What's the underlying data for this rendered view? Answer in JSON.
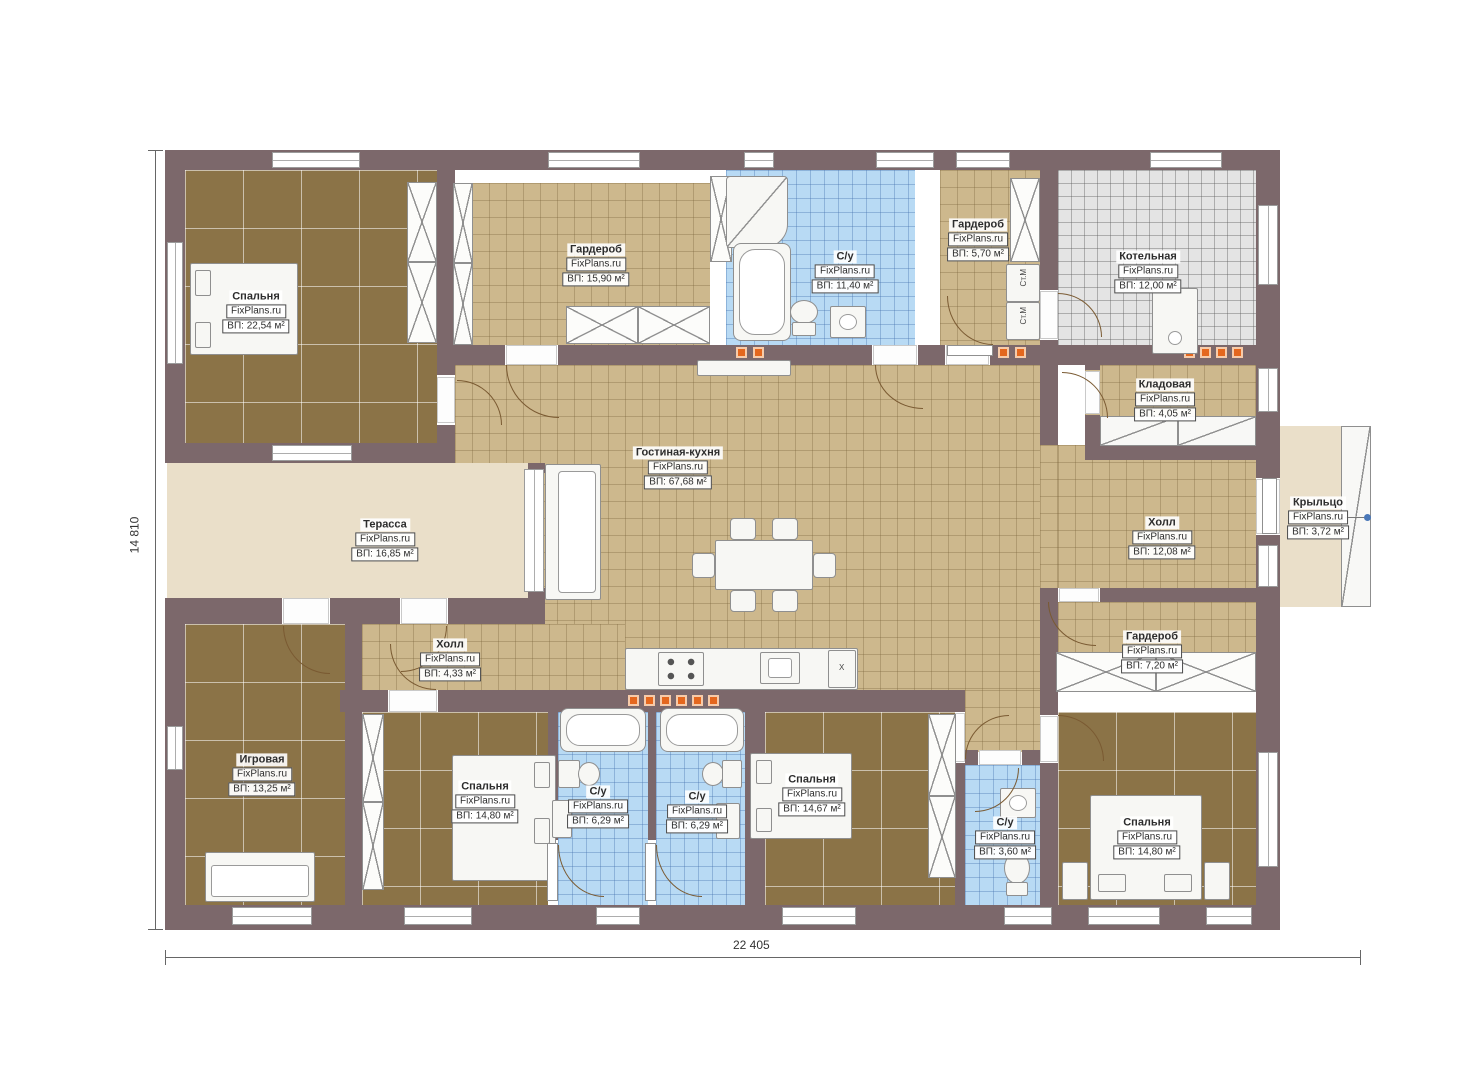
{
  "plan_title": "FixPlans.ru single-storey house floor plan",
  "brand": "FixPlans.ru",
  "rooms": [
    {
      "name": "Спальня",
      "brand": "FixPlans.ru",
      "area": "ВП: 22,54 м²"
    },
    {
      "name": "Гардероб",
      "brand": "FixPlans.ru",
      "area": "ВП: 15,90 м²"
    },
    {
      "name": "С/у",
      "brand": "FixPlans.ru",
      "area": "ВП: 11,40 м²"
    },
    {
      "name": "Гардероб",
      "brand": "FixPlans.ru",
      "area": "ВП: 5,70 м²"
    },
    {
      "name": "Котельная",
      "brand": "FixPlans.ru",
      "area": "ВП: 12,00 м²"
    },
    {
      "name": "Кладовая",
      "brand": "FixPlans.ru",
      "area": "ВП: 4,05 м²"
    },
    {
      "name": "Гостиная-кухня",
      "brand": "FixPlans.ru",
      "area": "ВП: 67,68 м²"
    },
    {
      "name": "Терасса",
      "brand": "FixPlans.ru",
      "area": "ВП: 16,85 м²"
    },
    {
      "name": "Холл",
      "brand": "FixPlans.ru",
      "area": "ВП: 12,08 м²"
    },
    {
      "name": "Крыльцо",
      "brand": "FixPlans.ru",
      "area": "ВП: 3,72 м²"
    },
    {
      "name": "Гардероб",
      "brand": "FixPlans.ru",
      "area": "ВП: 7,20 м²"
    },
    {
      "name": "Холл",
      "brand": "FixPlans.ru",
      "area": "ВП: 4,33 м²"
    },
    {
      "name": "Игровая",
      "brand": "FixPlans.ru",
      "area": "ВП: 13,25 м²"
    },
    {
      "name": "Спальня",
      "brand": "FixPlans.ru",
      "area": "ВП: 14,80 м²"
    },
    {
      "name": "С/у",
      "brand": "FixPlans.ru",
      "area": "ВП: 6,29 м²"
    },
    {
      "name": "С/у",
      "brand": "FixPlans.ru",
      "area": "ВП: 6,29 м²"
    },
    {
      "name": "Спальня",
      "brand": "FixPlans.ru",
      "area": "ВП: 14,67 м²"
    },
    {
      "name": "С/у",
      "brand": "FixPlans.ru",
      "area": "ВП: 3,60 м²"
    },
    {
      "name": "Спальня",
      "brand": "FixPlans.ru",
      "area": "ВП: 14,80 м²"
    }
  ],
  "dimensions": {
    "width_label": "22 405",
    "height_label": "14 810"
  },
  "appliances": {
    "washer": "Ст.М",
    "fridge": "Х"
  },
  "colors": {
    "wall": "#7c686b",
    "floor_wood": "#8b7347",
    "floor_tile": "#cdb88d",
    "floor_bath": "#b8daf4",
    "floor_boiler": "#e4e4e4",
    "floor_terrace": "#eadfc9",
    "vent": "#e4671e",
    "leader_dot": "#4a78b8"
  }
}
